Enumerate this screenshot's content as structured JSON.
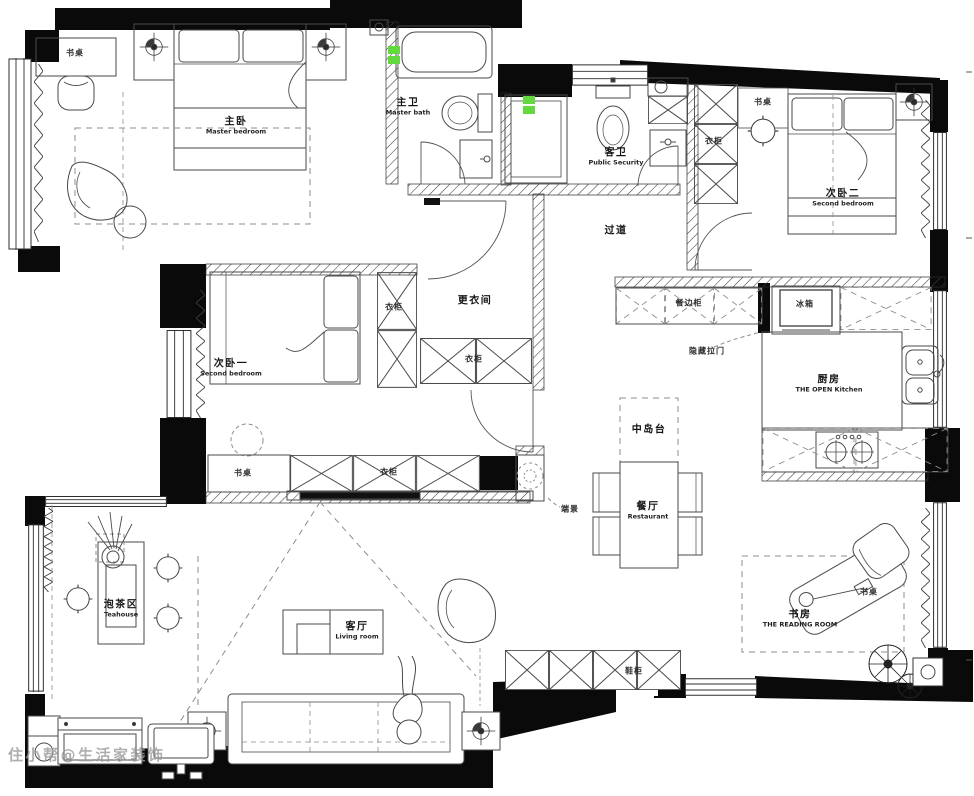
{
  "watermark": "住小帮@生活家装饰",
  "colors": {
    "accent_green": "#64d93f",
    "wall": "#0a0a0a",
    "line": "#4a4a4a"
  },
  "rooms": {
    "master_bedroom": {
      "zh": "主卧",
      "en": "Master bedroom"
    },
    "master_bath": {
      "zh": "主卫",
      "en": "Master bath"
    },
    "guest_bath": {
      "zh": "客卫",
      "en": "Public Security"
    },
    "second_bedroom_2": {
      "zh": "次卧二",
      "en": "Second bedroom"
    },
    "second_bedroom_1": {
      "zh": "次卧一",
      "en": "Second bedroom"
    },
    "corridor": {
      "zh": "过道"
    },
    "dressing_room": {
      "zh": "更衣间"
    },
    "kitchen": {
      "zh": "厨房",
      "en": "THE OPEN Kitchen"
    },
    "island": {
      "zh": "中岛台"
    },
    "dining_room": {
      "zh": "餐厅",
      "en": "Restaurant"
    },
    "tea_area": {
      "zh": "泡茶区",
      "en": "Teahouse"
    },
    "living_room": {
      "zh": "客厅",
      "en": "Living room"
    },
    "study": {
      "zh": "书房",
      "en": "THE READING ROOM"
    }
  },
  "furniture_labels": {
    "desk": "书桌",
    "wardrobe": "衣柜",
    "sideboard": "餐边柜",
    "fridge": "冰箱",
    "hidden_sliding_door": "隐藏拉门",
    "end_view": "端景",
    "shoe_cabinet": "鞋柜"
  }
}
